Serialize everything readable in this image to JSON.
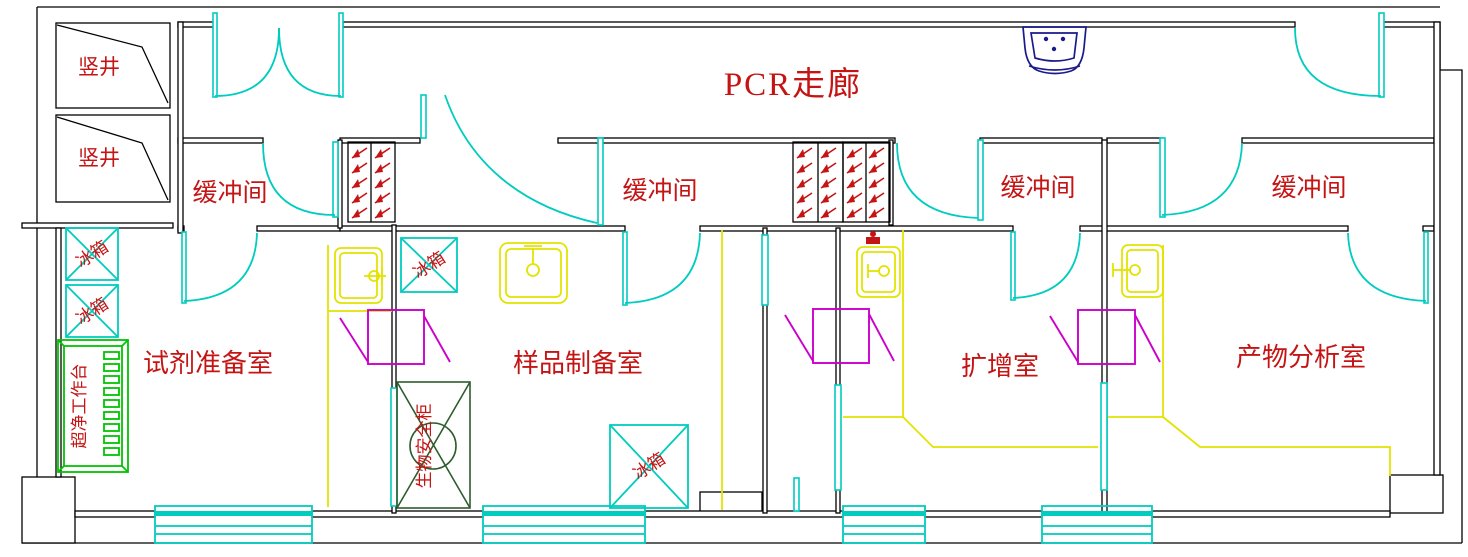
{
  "corridor": {
    "label": "PCR走廊"
  },
  "shafts": [
    {
      "label": "竖井"
    },
    {
      "label": "竖井"
    }
  ],
  "buffers": [
    {
      "label": "缓冲间"
    },
    {
      "label": "缓冲间"
    },
    {
      "label": "缓冲间"
    },
    {
      "label": "缓冲间"
    }
  ],
  "rooms": [
    {
      "name": "试剂准备室",
      "equipment": [
        {
          "label": "冰箱"
        },
        {
          "label": "冰箱"
        },
        {
          "label": "超净工作台"
        }
      ]
    },
    {
      "name": "样品制备室",
      "equipment": [
        {
          "label": "冰箱"
        },
        {
          "label": "冰箱"
        },
        {
          "label": "生物安全柜"
        }
      ]
    },
    {
      "name": "扩增室",
      "equipment": []
    },
    {
      "name": "产物分析室",
      "equipment": []
    }
  ],
  "colors": {
    "wall": "#000000",
    "door_glass": "#00ccbf",
    "fixture_yellow": "#e3e300",
    "pass_box": "#cc00cc",
    "clean_bench": "#00c400",
    "biosafety_cabinet": "#2d5c2d",
    "washbasin": "#1a1a8c",
    "label_red": "#c41414"
  }
}
